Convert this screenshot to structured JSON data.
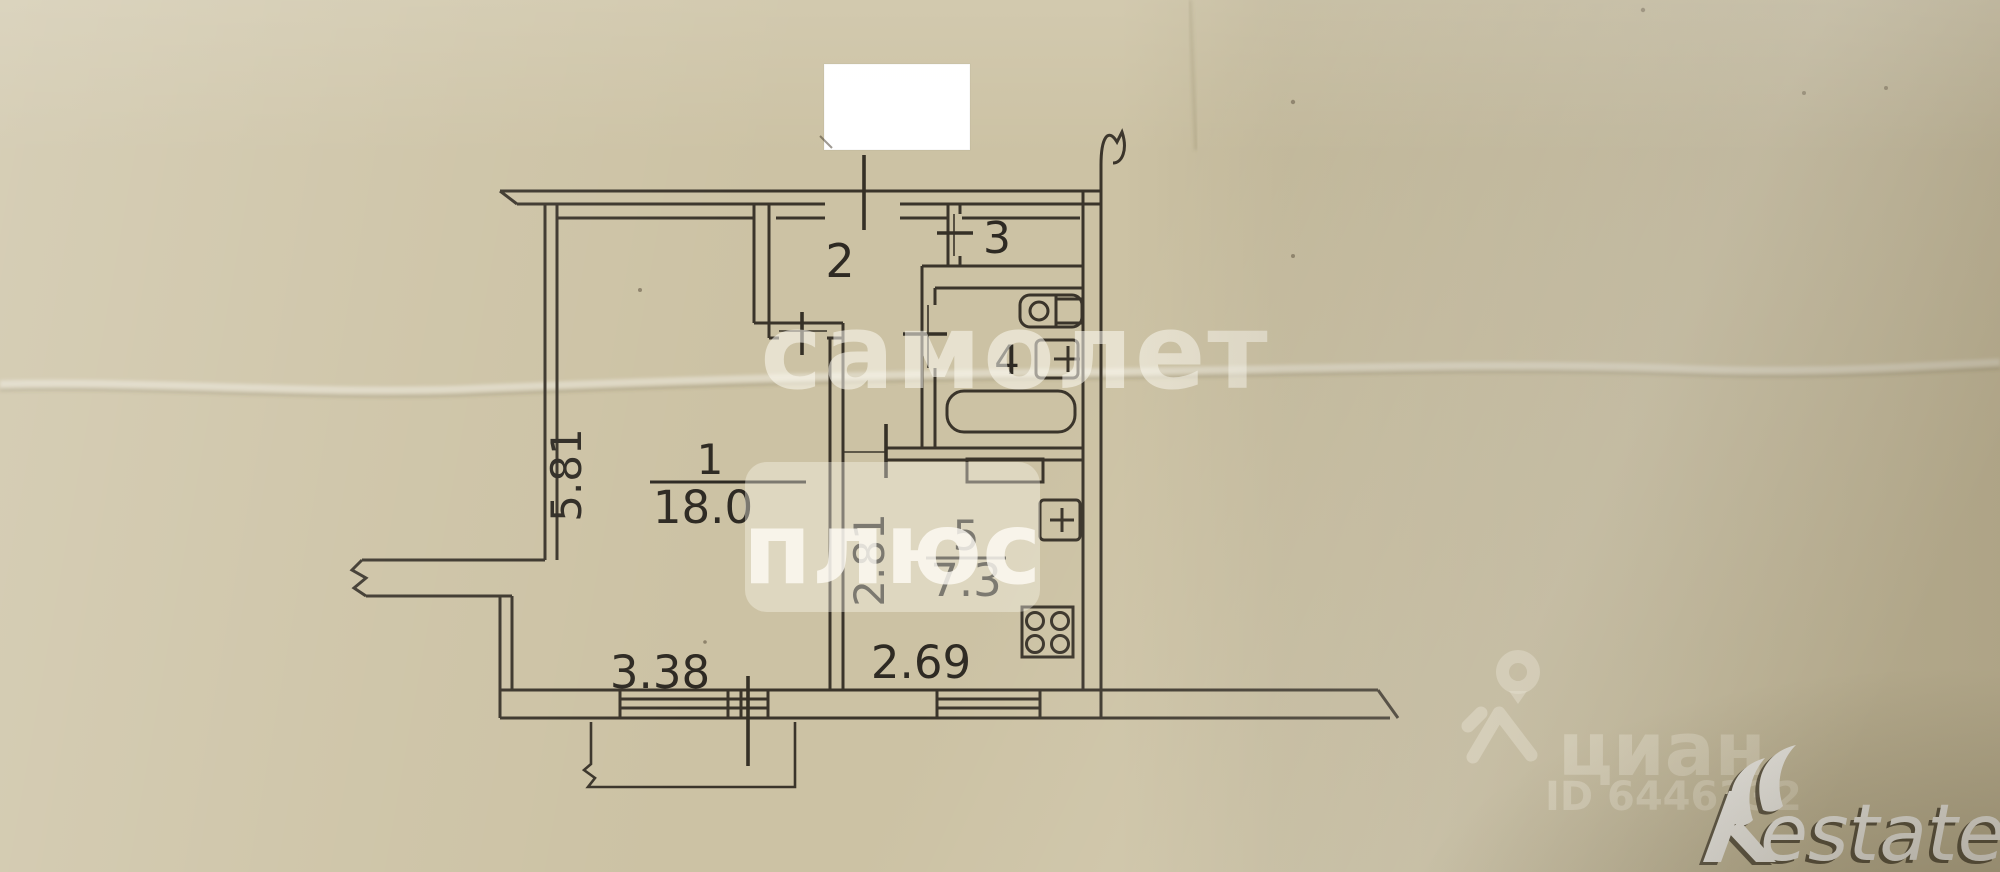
{
  "document": {
    "type": "floor-plan-scan",
    "description": "Scanned BTI floor plan of a one-room apartment on beige paper"
  },
  "floorplan": {
    "rooms": [
      {
        "number": "1",
        "area": "18.0"
      },
      {
        "number": "2",
        "area": ""
      },
      {
        "number": "3",
        "area": ""
      },
      {
        "number": "4",
        "area": ""
      },
      {
        "number": "5",
        "area": "7.3"
      }
    ],
    "dimensions": {
      "room1_height": "5.81",
      "room1_width": "3.38",
      "kitchen_height": "2.81",
      "kitchen_width": "2.69"
    }
  },
  "watermarks": {
    "samolet": {
      "line1": "самолет",
      "line2": "плюс"
    },
    "cian": {
      "name": "циан",
      "id_label": "ID 6446332"
    },
    "restate": {
      "text": "estate"
    }
  },
  "colors": {
    "paper": "#ccc2a4",
    "ink": "#3a342a",
    "watermark": "#fdfbf2",
    "censor": "#ffffff"
  }
}
